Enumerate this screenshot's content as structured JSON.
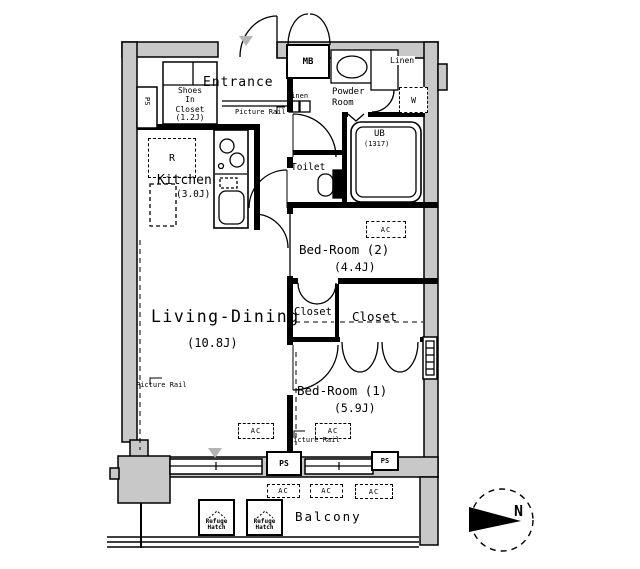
{
  "plan": {
    "rooms": {
      "entrance": {
        "name": "Entrance"
      },
      "shoes_closet": {
        "name": "Shoes\nIn\nCloset",
        "size": "(1.2J)"
      },
      "kitchen": {
        "name": "Kitchen",
        "size": "(3.0J)"
      },
      "living_dining": {
        "name": "Living-Dining",
        "size": "(10.8J)"
      },
      "bedroom2": {
        "name": "Bed-Room (2)",
        "size": "(4.4J)"
      },
      "bedroom1": {
        "name": "Bed-Room (1)",
        "size": "(5.9J)"
      },
      "powder_room": {
        "name": "Powder\nRoom"
      },
      "toilet": {
        "name": "Toilet"
      },
      "unit_bath": {
        "name": "UB",
        "size": "(1317)"
      },
      "closet_a": {
        "name": "Closet"
      },
      "closet_b": {
        "name": "Closet"
      },
      "linen_a": {
        "name": "Linen"
      },
      "linen_b": {
        "name": "Linen"
      },
      "balcony": {
        "name": "Balcony"
      }
    },
    "fixtures": {
      "meter_box": "MB",
      "pipe_space": "PS",
      "air_conditioner": "AC",
      "washer": "W",
      "refrigerator": "R",
      "picture_rail": "Picture Rail",
      "refuge_hatch": "Refuge\nHatch"
    },
    "compass": {
      "north": "N"
    }
  },
  "colors": {
    "wall_fill": "#c8c8c8",
    "line": "#000000",
    "background": "#ffffff",
    "marker": "#b4b4b4"
  }
}
